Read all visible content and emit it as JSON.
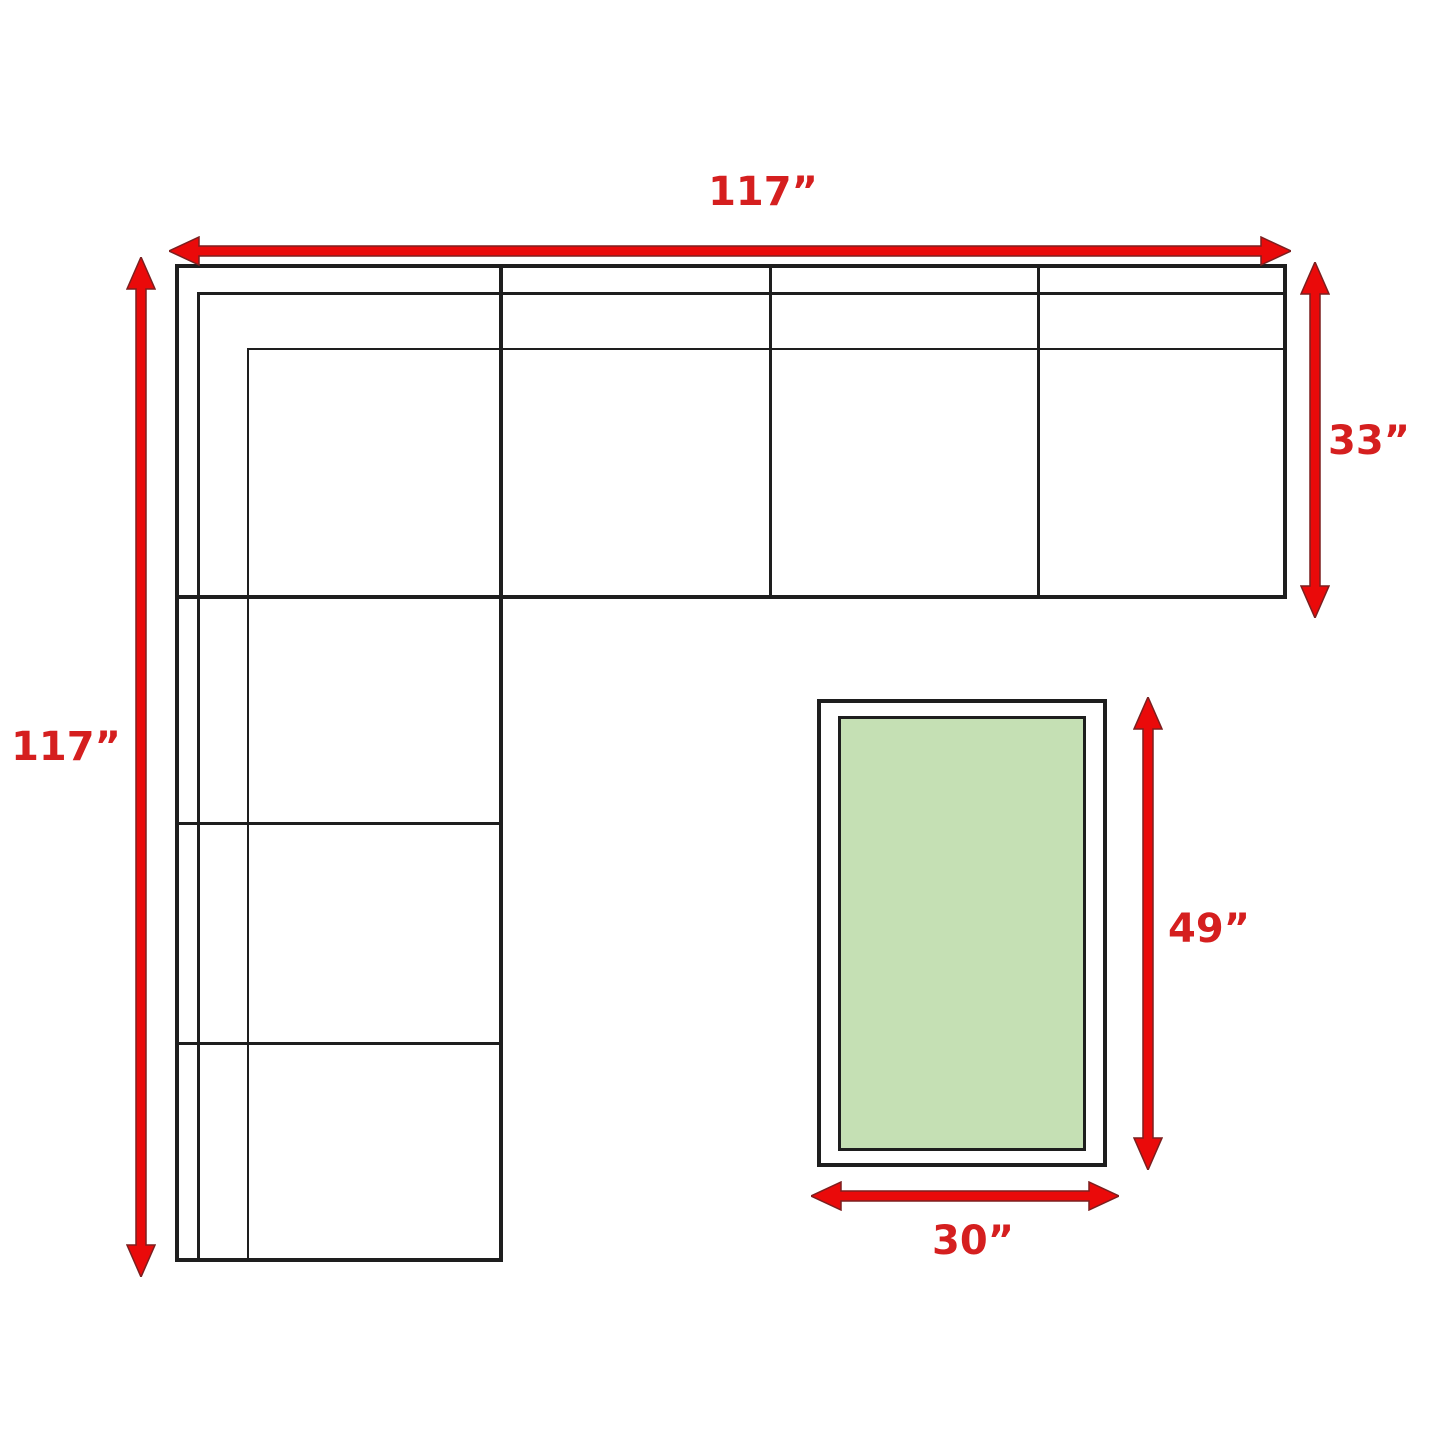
{
  "diagram": {
    "name": "Sectional sofa and coffee table dimension plan",
    "labels": {
      "sofa_width_top": "117”",
      "sofa_length_left": "117”",
      "section_depth_right": "33”",
      "table_length": "49”",
      "table_width": "30”"
    },
    "colors": {
      "arrow_fill": "#ea0a0a",
      "arrow_outline": "#7c1f1f",
      "label_text": "#d51f1f",
      "outline_black": "#1e1e1e",
      "table_top_green": "#c5e0b4",
      "background": "#ffffff"
    }
  }
}
